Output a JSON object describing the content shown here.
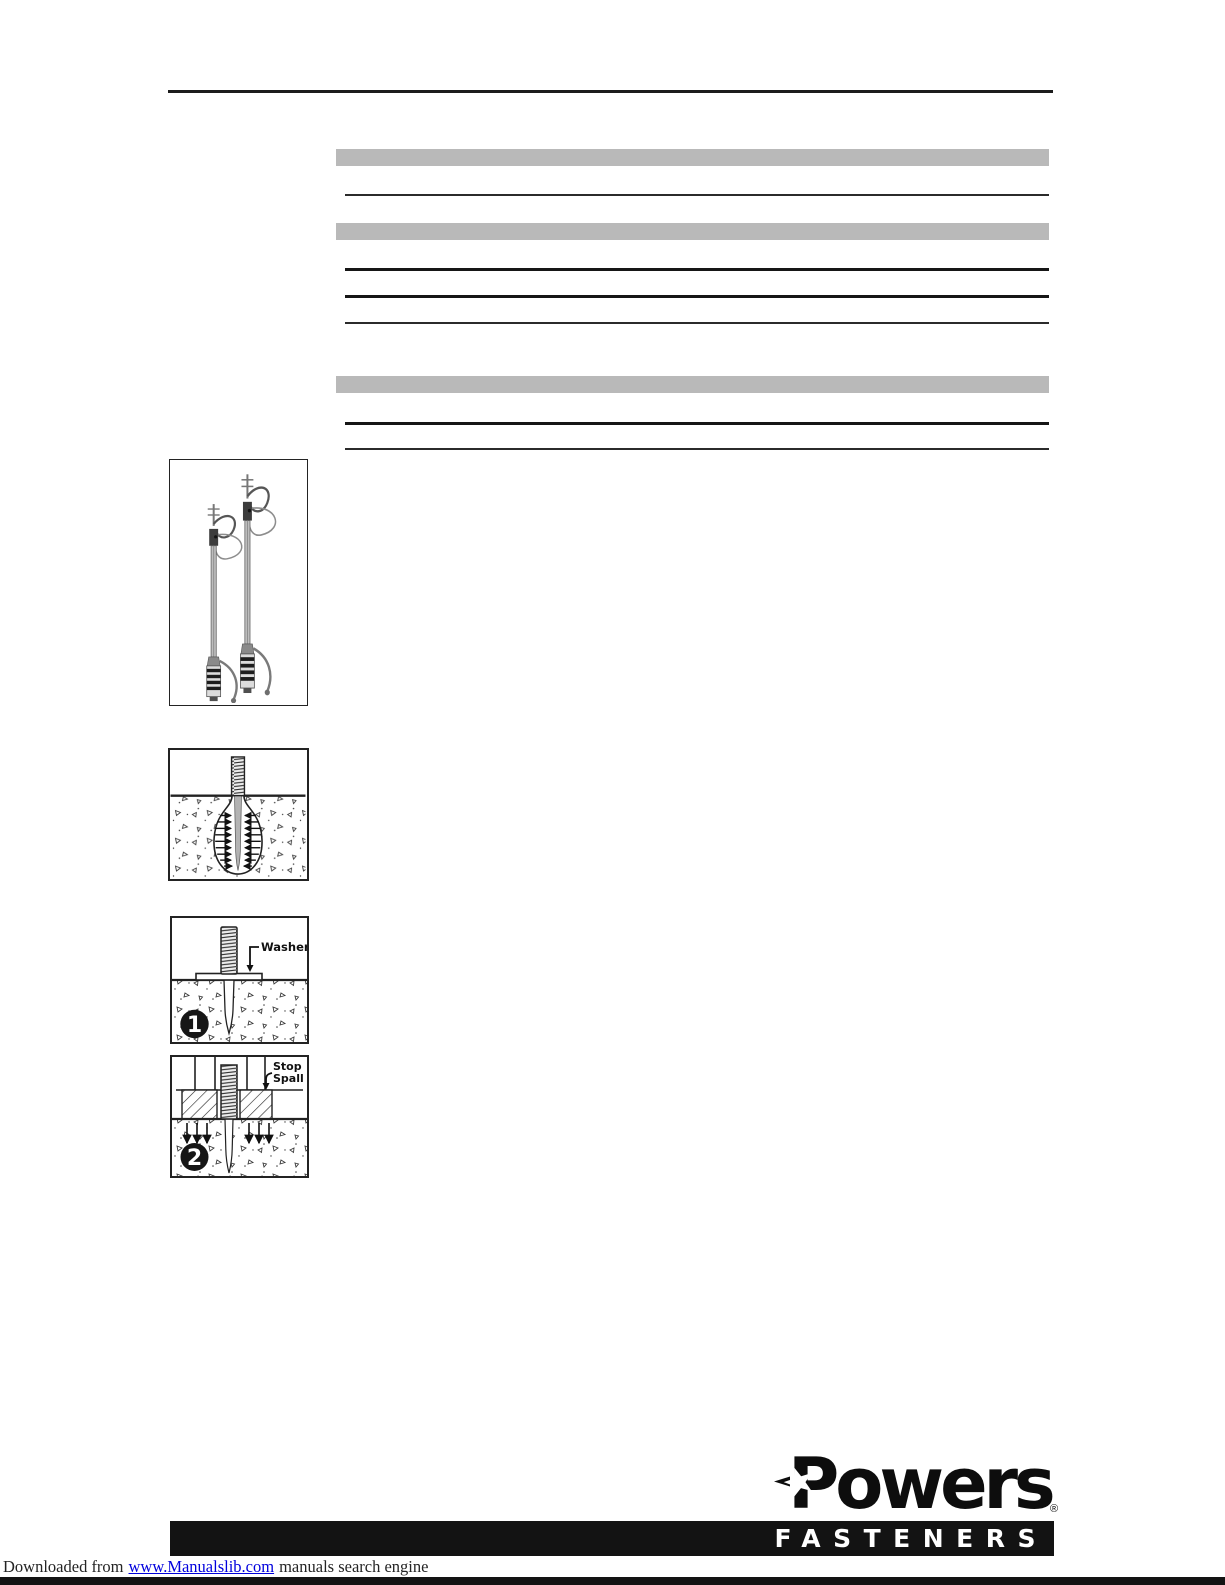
{
  "colors": {
    "table_bar_gray": "#b9b9b9",
    "rule_black": "#161616",
    "banner_black": "#131313",
    "link_blue": "#0000dd"
  },
  "figures": {
    "step1": {
      "label": "Washer",
      "step_number": "1"
    },
    "step2": {
      "label_line1": "Stop",
      "label_line2": "Spall",
      "step_number": "2"
    }
  },
  "logo": {
    "brand": "Powers",
    "registered_mark": "®",
    "banner": "FASTENERS"
  },
  "footer": {
    "prefix": "Downloaded from",
    "link_text": "www.Manualslib.com",
    "suffix": "manuals search engine"
  }
}
